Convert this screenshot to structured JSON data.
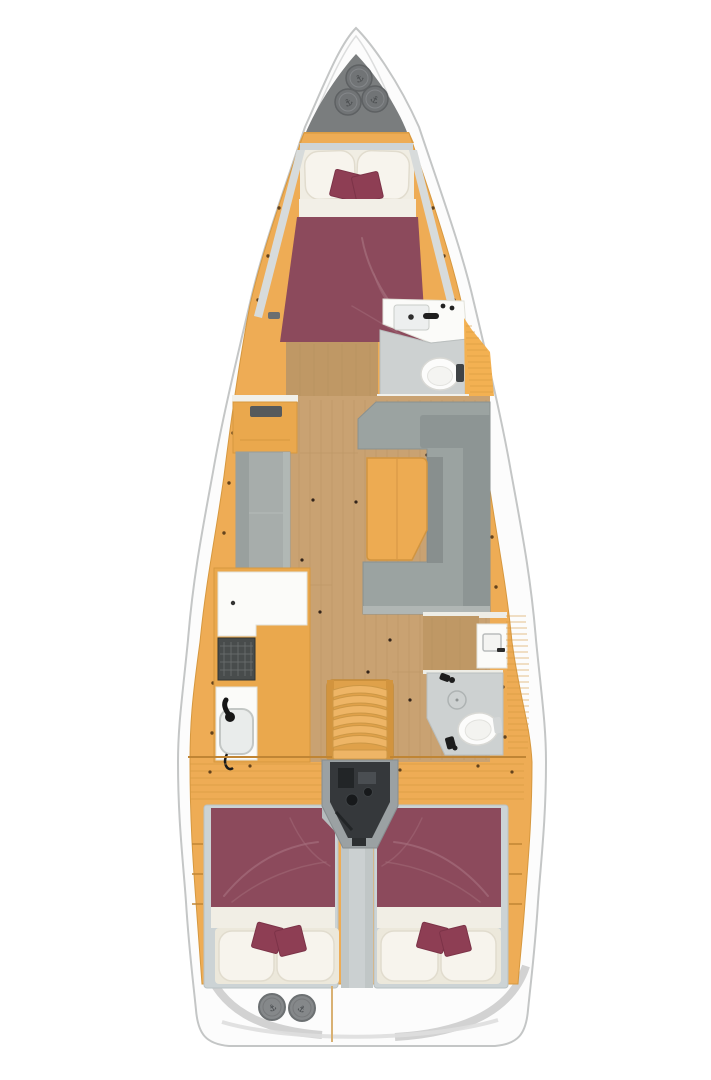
{
  "page": {
    "description": "Top-down interior floor plan of a sailing yacht, bow up",
    "background": "#ffffff"
  },
  "colors": {
    "hull": "#fcfcfc",
    "hull_outline": "#c4c6c6",
    "deck": "#eeac55",
    "deck_line": "#d6983f",
    "floor": "#c9a272",
    "floor_line": "#b08a58",
    "sole": "#bf9865",
    "fixture": "#fbfbf9",
    "shower": "#cdd1d1",
    "settee": "#a7adab",
    "sofa": "#9ba3a1",
    "sofa_dark": "#8d9594",
    "table": "#edab52",
    "maroon": "#8c4a5c",
    "maroon_fold": "#a36b79",
    "cushion": "#8e3e54",
    "pillow": "#f7f4ed",
    "cream": "#f0ede3",
    "frame": "#ccd3d5",
    "corridor": "#c0c6c6",
    "locker": "#7a7d7e",
    "hatch": "#85888a",
    "engine": "#35383b",
    "stove": "#484c4c",
    "cowling": "#9ba1a3"
  },
  "regions": {
    "bow": {
      "anchor_locker_hatches": 3,
      "hatch_symbol": "anchor"
    },
    "forward_cabin": {
      "bed": "double V-berth",
      "pillows": 2,
      "accent_cushions": 2,
      "bedding_color": "#8c4a5c"
    },
    "forward_head": {
      "fixtures": [
        "sink",
        "faucet",
        "toilet",
        "shower-floor"
      ],
      "louvered_wardrobe": true
    },
    "salon": {
      "port": [
        "cabinet-with-instrument",
        "settee"
      ],
      "starboard": [
        "u-shaped-sofa",
        "table"
      ]
    },
    "galley": {
      "fixtures": [
        "l-counter",
        "stove",
        "sink",
        "faucet"
      ]
    },
    "companionway": {
      "steps": 7
    },
    "engine_compartment": {
      "position": "below companionway"
    },
    "aft_cabin_port": {
      "bed": "double",
      "pillows": 2,
      "accent_cushions": 2
    },
    "aft_cabin_starboard": {
      "bed": "double",
      "pillows": 2,
      "accent_cushions": 2
    },
    "aft_head": {
      "fixtures": [
        "sink-cabinet",
        "toilet",
        "shower-floor",
        "drain"
      ]
    },
    "stern": {
      "deck_hatches": 2,
      "hatch_symbol": "anchor"
    }
  }
}
